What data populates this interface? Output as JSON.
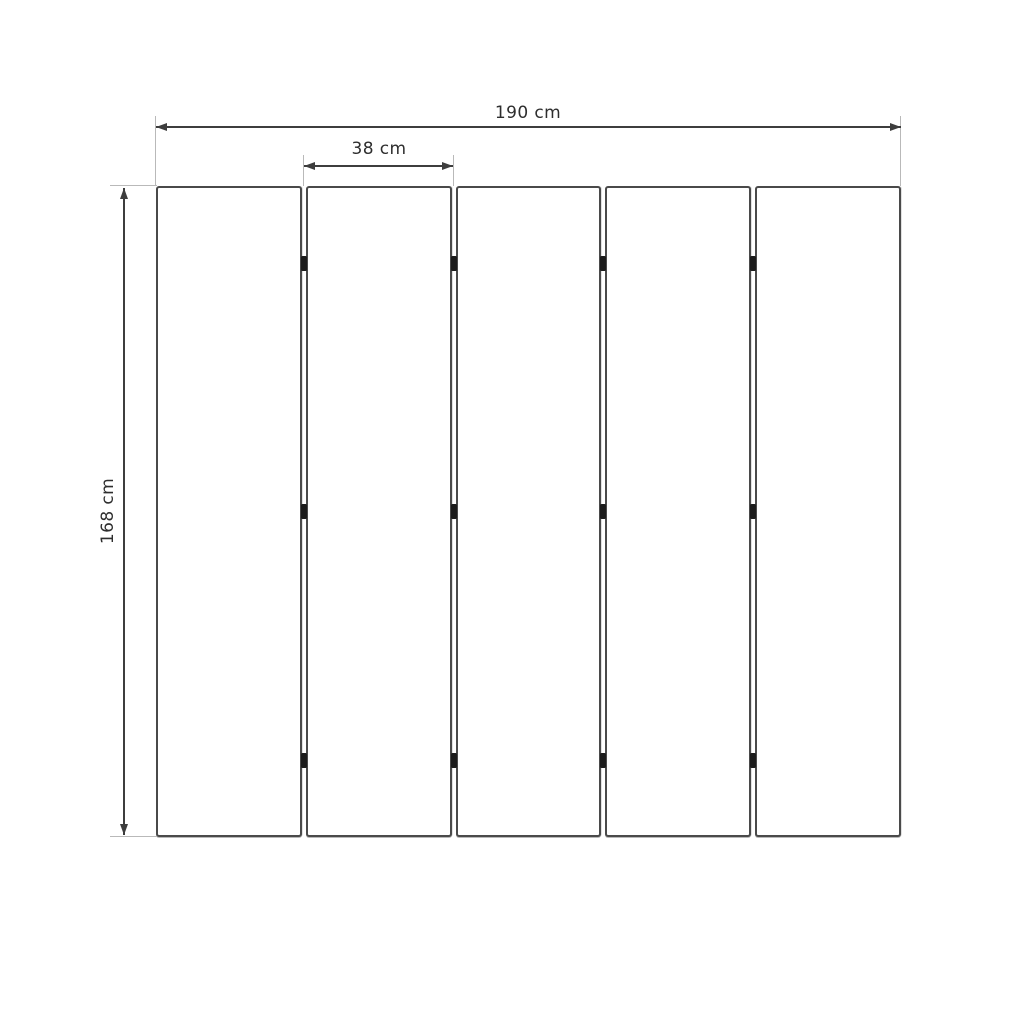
{
  "diagram": {
    "title": "five-panel folding screen dimensioned drawing",
    "labels": {
      "total_width": "190 cm",
      "panel_width": "38 cm",
      "height": "168 cm"
    },
    "panels": {
      "count": 5,
      "hinge_rows": 3
    },
    "colors": {
      "background": "#ffffff",
      "panel_fill": "#ffffff",
      "panel_border": "#4a4a4a",
      "hinge": "#1c1c1c",
      "dimension_line": "#3d3d3d",
      "extension_line": "#b9b9b9",
      "text": "#2e2e2e"
    }
  }
}
